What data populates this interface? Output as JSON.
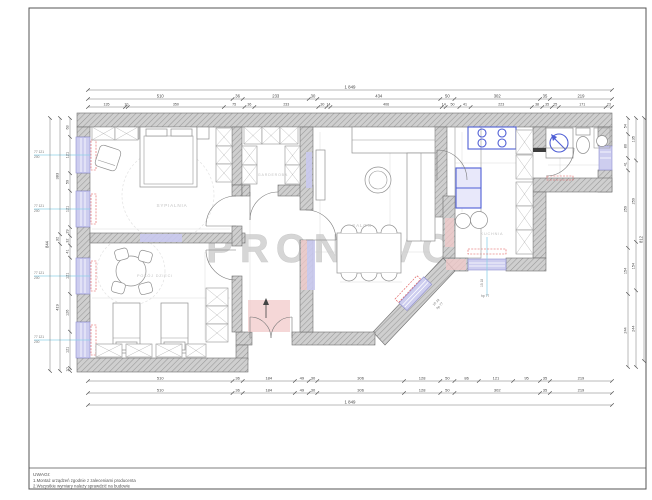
{
  "watermark": "PRONOVO",
  "notes": {
    "title": "UWAGI:",
    "line1": "1.Montaż urządzeń zgodnie z zaleceniami producenta",
    "line2": "2.Wszystkie wymiary należy sprawdzić na budowie"
  },
  "rooms": {
    "bedroom": "SYPIALNIA",
    "wardrobe": "GARDEROBA",
    "kids_room": "POKÓJ DZIECI",
    "living": "SALON",
    "kitchen": "KUCHNIA"
  },
  "dims": {
    "top_total": [
      "1 849"
    ],
    "top_row2": [
      "510",
      "36",
      "233",
      "30",
      "434",
      "50",
      "302",
      "35",
      "219"
    ],
    "top_row3": [
      "135",
      "10",
      "350",
      "75",
      "36",
      "233",
      "30",
      "14",
      "406",
      "14",
      "50",
      "41",
      "223",
      "38",
      "35",
      "25",
      "171",
      "23"
    ],
    "bottom_row1": [
      "510",
      "36",
      "184",
      "49",
      "30",
      "306",
      "128",
      "50",
      "86",
      "121",
      "95",
      "35",
      "219"
    ],
    "bottom_row2": [
      "510",
      "36",
      "184",
      "49",
      "30",
      "306",
      "128",
      "50",
      "302",
      "35",
      "219"
    ],
    "bottom_total": [
      "1 849"
    ],
    "left_inner": [
      "63",
      "121",
      "59",
      "121",
      "29",
      "32",
      "41",
      "121",
      "126",
      "121",
      "10"
    ],
    "left_mid": [
      "383",
      "32",
      "419"
    ],
    "left_outer": [
      "844"
    ],
    "right_inner": [
      "54",
      "80",
      "41",
      "259",
      "154",
      "244"
    ],
    "right_mid": [
      "135",
      "259",
      "154",
      "244"
    ],
    "right_outer": [
      "812"
    ]
  },
  "window_labels": {
    "left_top": "77 121",
    "left_bottom": "200",
    "entry_top": "15 18",
    "entry_bottom": "hp 77",
    "angled_top": "15 18",
    "angled_bottom": "hp 77"
  },
  "colors": {
    "wall_gray": "#c9c9c9",
    "appliance_blue": "#4f5fd5",
    "window_lavender": "#c9c9ee",
    "axis_blue": "#8fd0e8",
    "radiator_red": "#e05555",
    "tint_pink": "#f2caca",
    "watermark_gray": "#d2d2d2"
  }
}
